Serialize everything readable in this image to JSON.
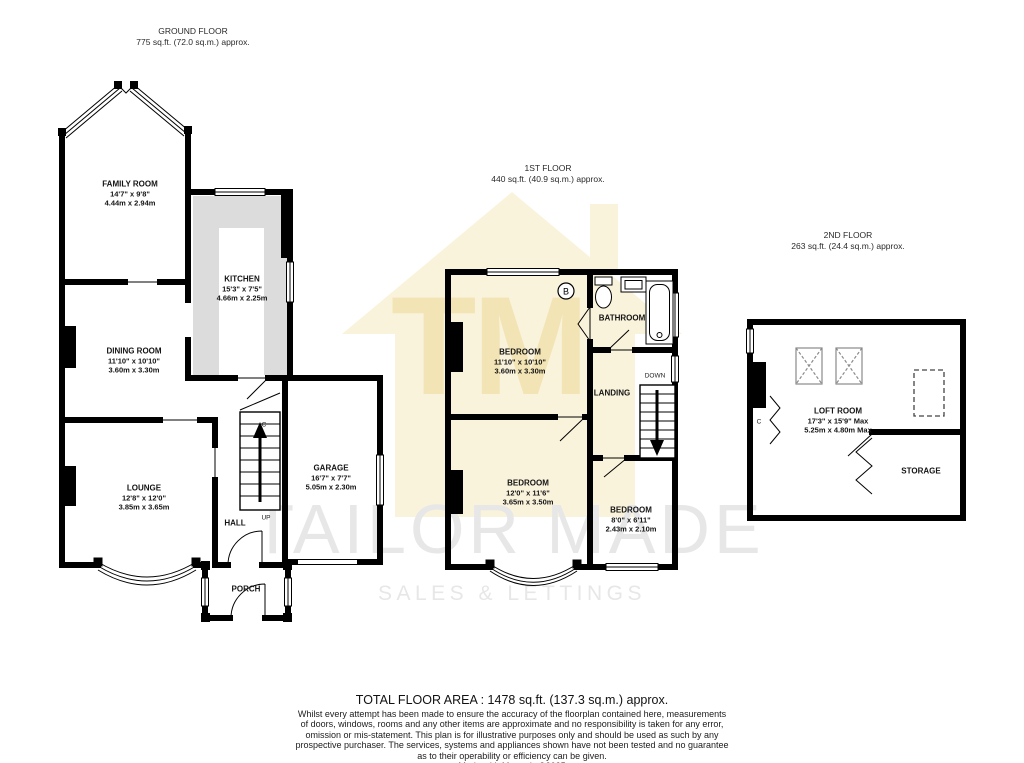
{
  "watermark": {
    "initials": "TM",
    "name": "TAILOR MADE",
    "tagline": "SALES & LETTINGS",
    "house_color": "#FAF3DC",
    "initials_color": "#F2E4B4",
    "text_color": "#E7E7E7"
  },
  "floors": {
    "ground": {
      "title": "GROUND FLOOR",
      "area": "775 sq.ft. (72.0 sq.m.) approx.",
      "rooms": {
        "family": {
          "name": "FAMILY ROOM",
          "imperial": "14'7\" x 9'8\"",
          "metric": "4.44m x 2.94m"
        },
        "kitchen": {
          "name": "KITCHEN",
          "imperial": "15'3\" x 7'5\"",
          "metric": "4.66m x 2.25m"
        },
        "dining": {
          "name": "DINING ROOM",
          "imperial": "11'10\" x 10'10\"",
          "metric": "3.60m x 3.30m"
        },
        "lounge": {
          "name": "LOUNGE",
          "imperial": "12'8\" x 12'0\"",
          "metric": "3.85m x 3.65m"
        },
        "garage": {
          "name": "GARAGE",
          "imperial": "16'7\" x 7'7\"",
          "metric": "5.05m x 2.30m"
        },
        "hall": {
          "name": "HALL"
        },
        "porch": {
          "name": "PORCH"
        }
      },
      "stairs": "UP",
      "cupboard": "C"
    },
    "first": {
      "title": "1ST FLOOR",
      "area": "440 sq.ft. (40.9 sq.m.) approx.",
      "rooms": {
        "bedroom1": {
          "name": "BEDROOM",
          "imperial": "11'10\" x 10'10\"",
          "metric": "3.60m x 3.30m"
        },
        "bathroom": {
          "name": "BATHROOM"
        },
        "landing": {
          "name": "LANDING"
        },
        "bedroom2": {
          "name": "BEDROOM",
          "imperial": "12'0\" x 11'6\"",
          "metric": "3.65m x 3.50m"
        },
        "bedroom3": {
          "name": "BEDROOM",
          "imperial": "8'0\" x 6'11\"",
          "metric": "2.43m x 2.10m"
        }
      },
      "stairs": "DOWN",
      "boiler": "B"
    },
    "second": {
      "title": "2ND FLOOR",
      "area": "263 sq.ft. (24.4 sq.m.) approx.",
      "rooms": {
        "loft": {
          "name": "LOFT ROOM",
          "imperial": "17'3\" x 15'9\" Max",
          "metric": "5.25m x 4.80m Max"
        },
        "storage": {
          "name": "STORAGE"
        }
      },
      "cupboard": "C"
    }
  },
  "footer": {
    "total": "TOTAL FLOOR AREA : 1478 sq.ft. (137.3 sq.m.) approx.",
    "disclaimer": "Whilst every attempt has been made to ensure the accuracy of the floorplan contained here, measurements of doors, windows, rooms and any other items are approximate and no responsibility is taken for any error, omission or mis-statement. This plan is for illustrative purposes only and should be used as such by any prospective purchaser. The services, systems and appliances shown have not been tested and no guarantee as to their operability or efficiency can be given.",
    "credit": "Made with Metropix ©2025"
  }
}
